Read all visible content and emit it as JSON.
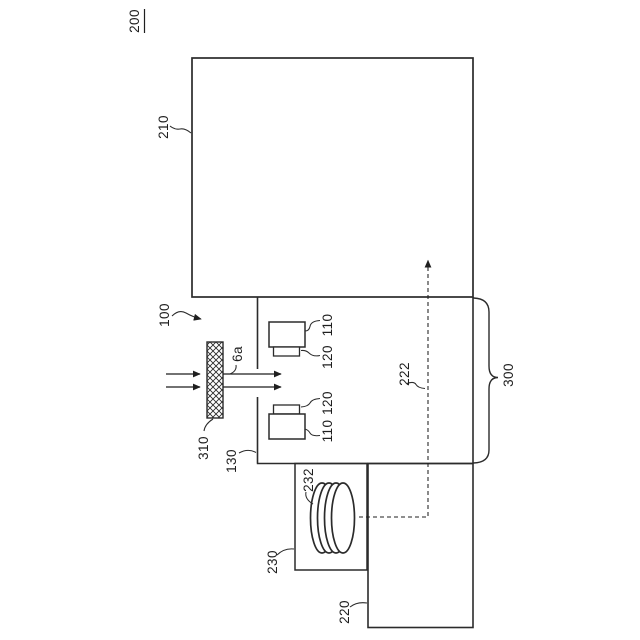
{
  "figure": {
    "number": "200"
  },
  "labels": {
    "upper_chamber": "210",
    "beam_source": "100",
    "filter_plate": "310",
    "aperture": "6a",
    "process_chamber": "130",
    "upper_unit_body": "110",
    "upper_unit_head": "120",
    "lower_unit_head": "120",
    "lower_unit_body": "110",
    "flow_path": "222",
    "source_assembly": "300",
    "coil": "232",
    "coil_housing": "230",
    "pump_unit": "220"
  }
}
